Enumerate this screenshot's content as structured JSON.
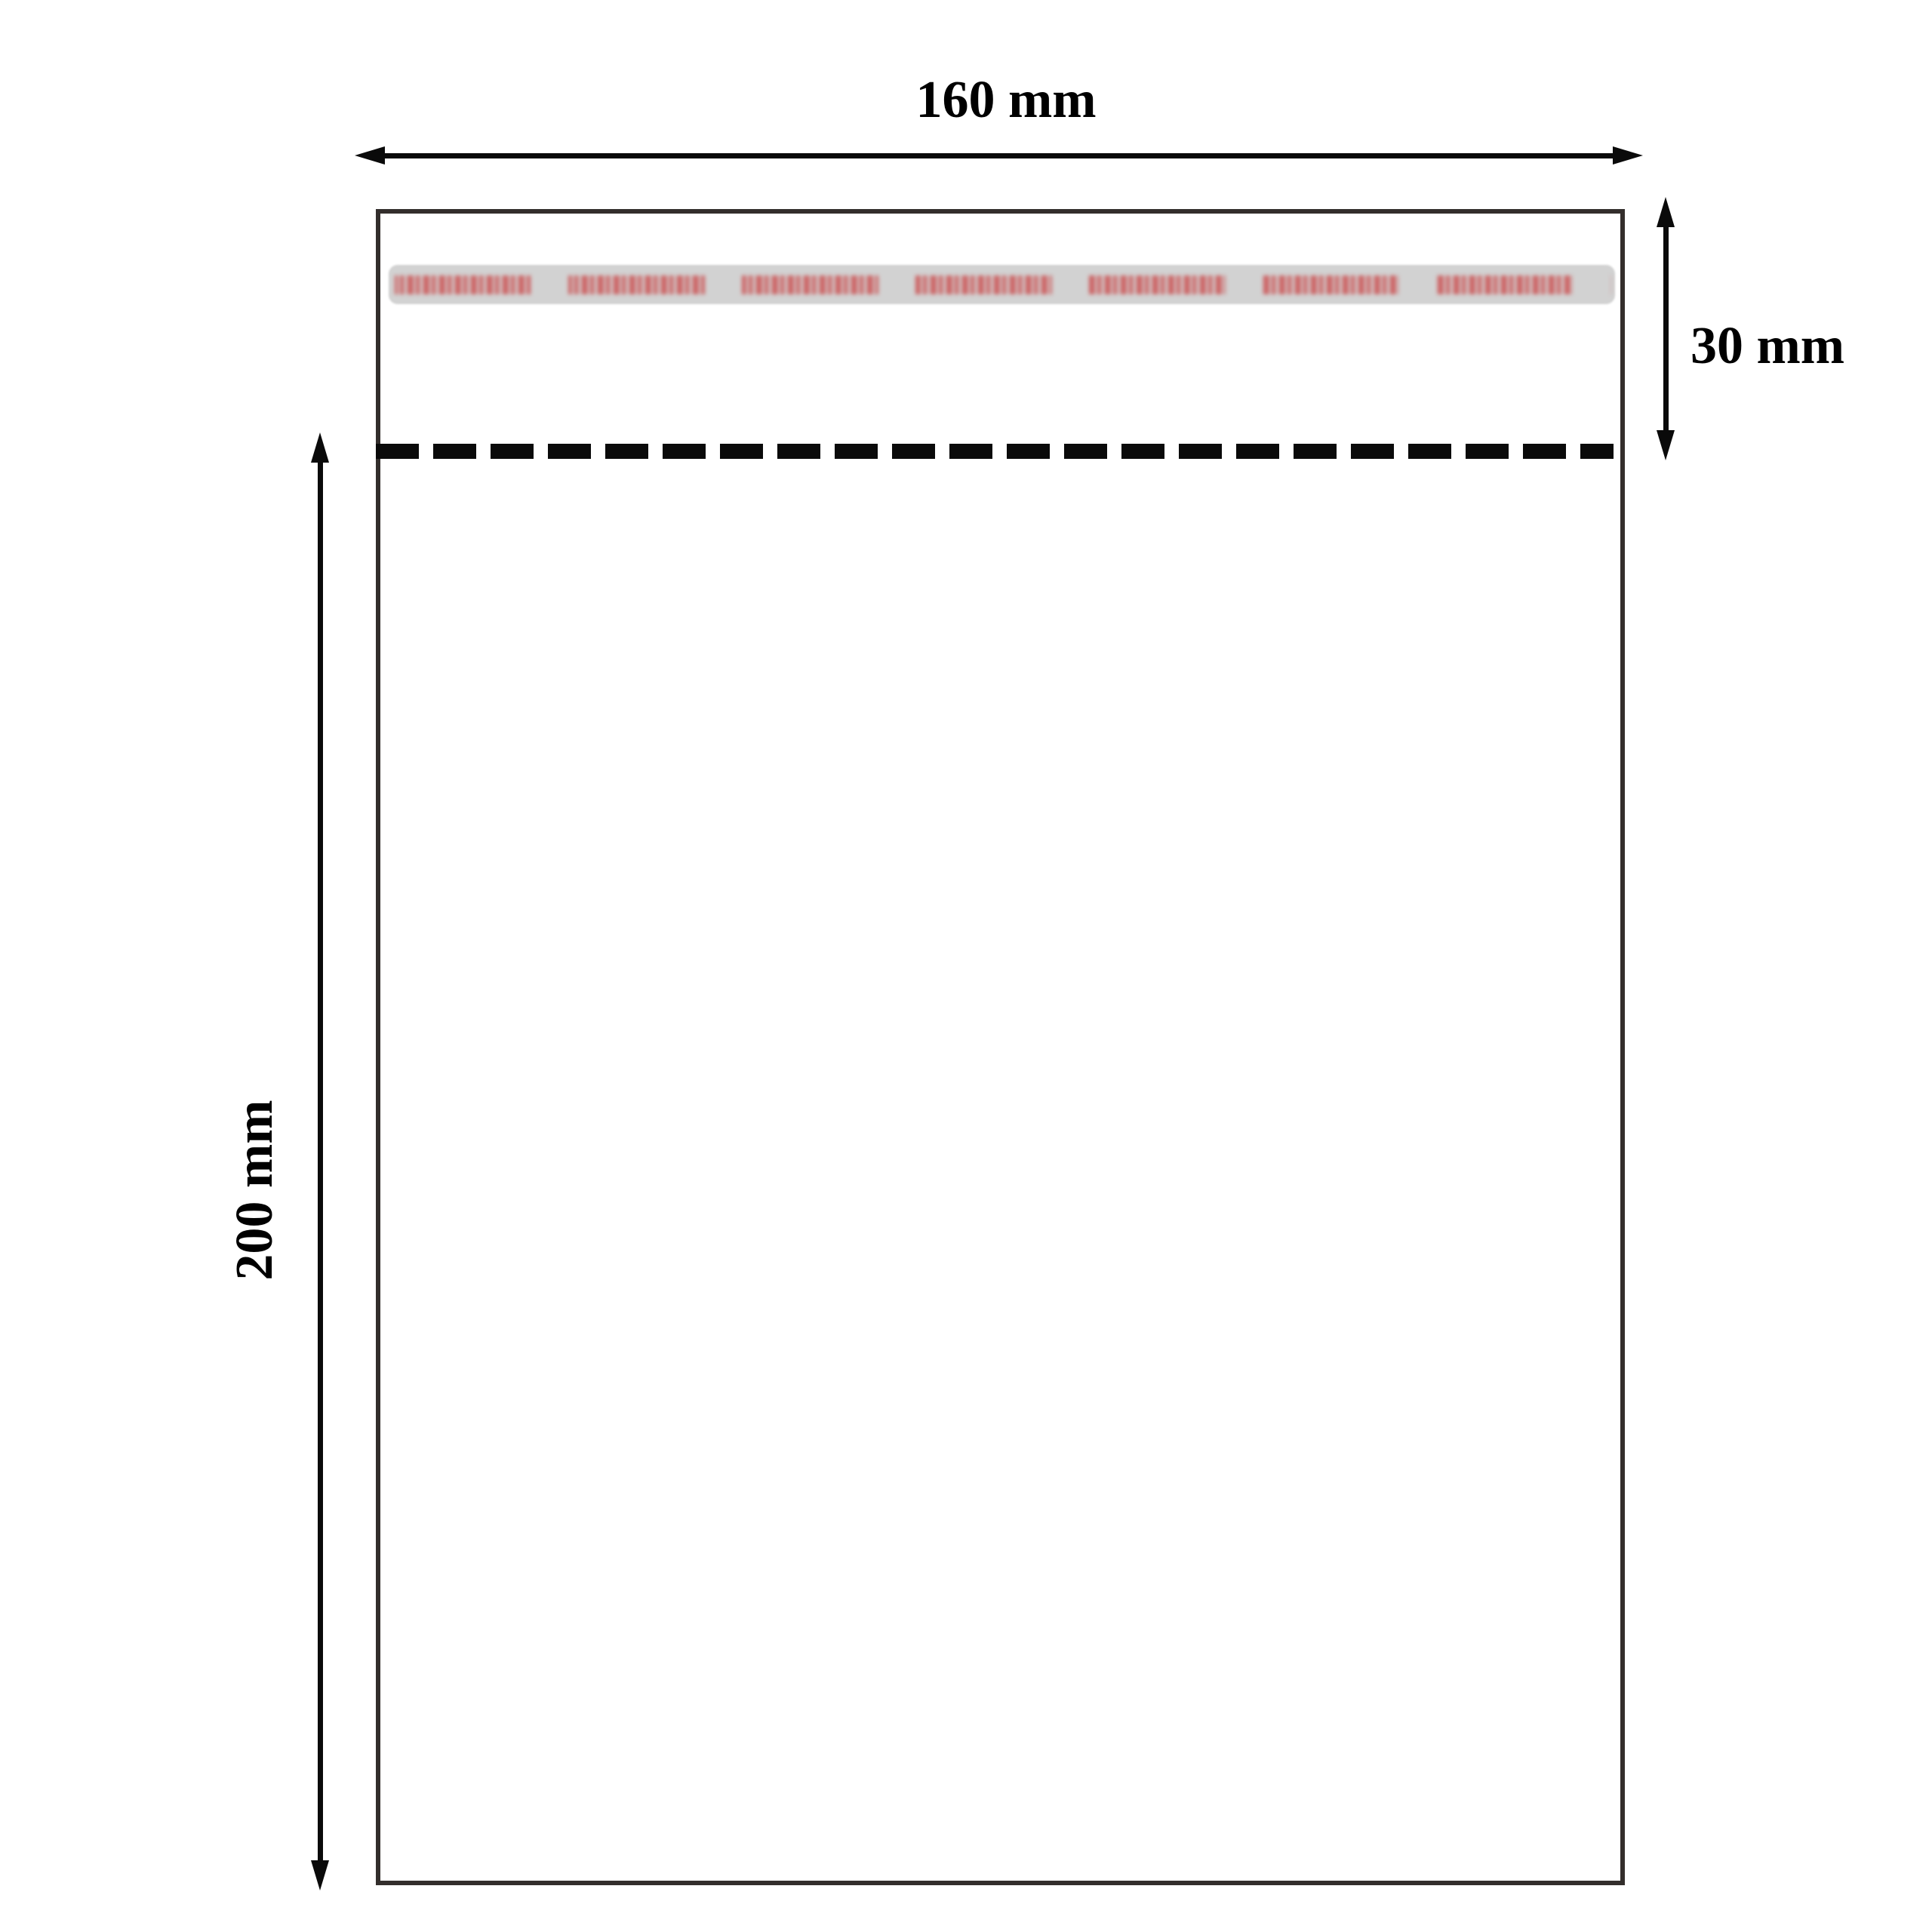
{
  "figure": {
    "type": "packaging-dimension-diagram",
    "subject": "self-seal transparent bag with adhesive flap",
    "labels": {
      "width": "160 mm",
      "height": "200 mm",
      "flap": "30 mm"
    },
    "colors": {
      "background": "#ffffff",
      "outline": "#332e2c",
      "bag-fill": "#ffffff",
      "arrow": "#0a0a0a",
      "dash": "#0a0a0a",
      "label": "#000000",
      "strip-bg": "#d2d2d2",
      "strip-print": "#cc6263"
    }
  }
}
